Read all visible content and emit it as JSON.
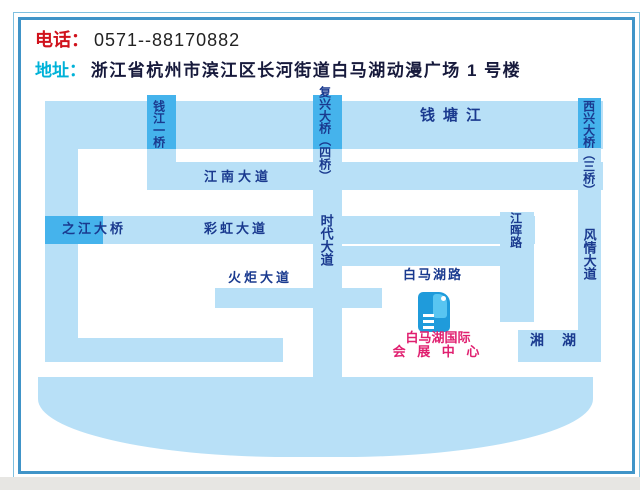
{
  "header": {
    "phone_label": "电话：",
    "phone_number": "0571--88170882",
    "address_label": "地址：",
    "address": "浙江省杭州市滨江区长河街道白马湖动漫广场 1 号楼"
  },
  "map": {
    "labels": {
      "qiantang_river": "钱塘江",
      "qianjiang_bridge": "钱江一桥",
      "fuxing_bridge": "复兴大桥（四桥）",
      "xixing_bridge": "西兴大桥（三桥）",
      "jiangnan_avenue": "江南大道",
      "zhijiang_bridge": "之江大桥",
      "caihong_avenue": "彩虹大道",
      "shidai_avenue": "时代大道",
      "jianghui_road": "江晖路",
      "fengqing_avenue": "风情大道",
      "huoju_avenue": "火炬大道",
      "baimahu_road": "白马湖路",
      "xiang_lake": "湘湖",
      "venue_line1": "白马湖国际",
      "venue_line2": "会 展 中 心"
    }
  },
  "theme": {
    "road": "#b8e0f7",
    "bridge": "#45b3ec",
    "map_label": "#1a3a8f",
    "venue_label": "#e02070",
    "phone_label": "#d0121c",
    "address_label": "#00b2d8",
    "frame_outer": "#7fc0e0",
    "frame_inner": "#4094c8",
    "building": "#1f9bdb",
    "building_light": "#58c5f1"
  }
}
